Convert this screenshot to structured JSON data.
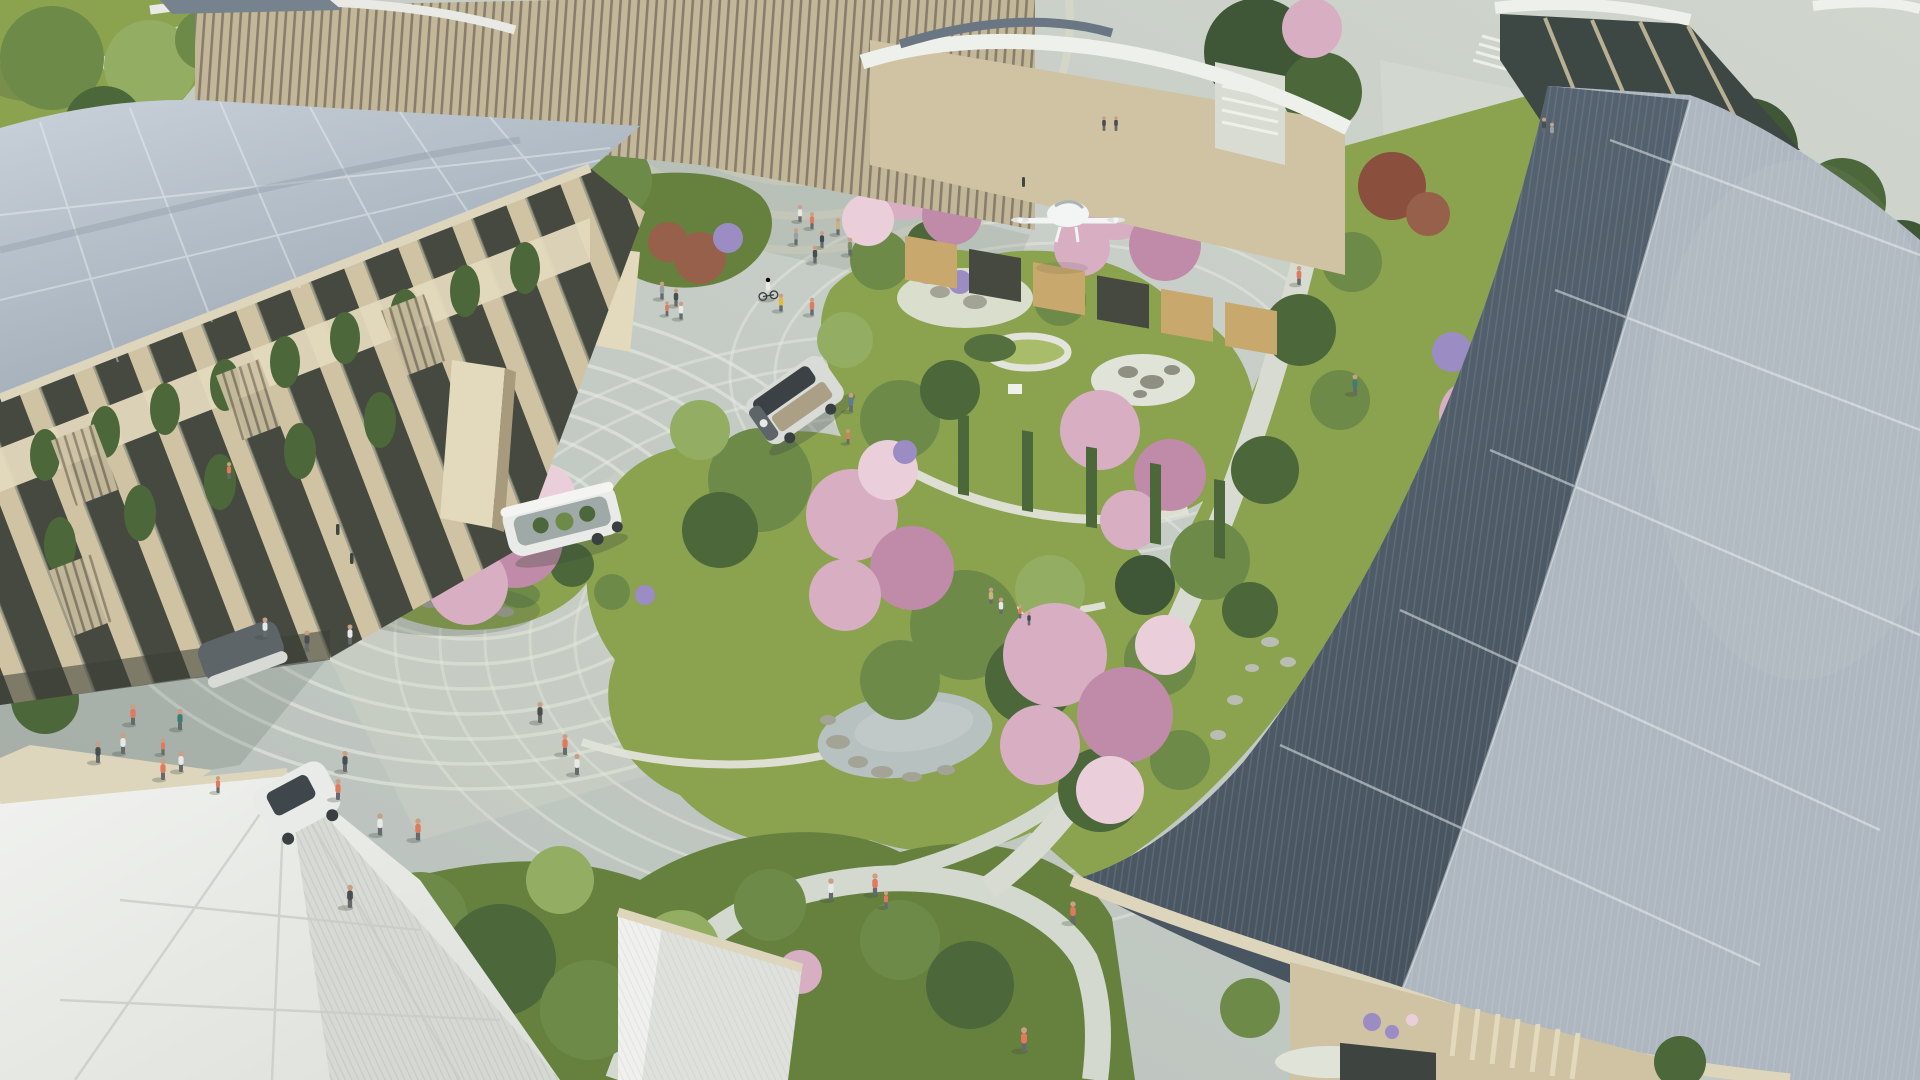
{
  "meta": {
    "title": "Aerial rendering — car-free smart neighborhood plaza",
    "type": "architectural rendering",
    "view": "aerial oblique, daytime",
    "description": "Sunlit aerial view of a woven-city style neighborhood: mass-timber buildings with curved solar roofs, a central Japanese garden with cherry blossoms, a pond and zen gravel circles, wavy-striped pedestrian plazas, autonomous shuttles, a hovering delivery drone and many pedestrians."
  },
  "palette": {
    "pavement": "#c3cac4",
    "pavementLight": "#d6dbd2",
    "stripe": "#e9ece3",
    "terrace": "#dbd8c6",
    "grass": "#8ba24f",
    "grassLight": "#a9bc69",
    "grassDark": "#66813e",
    "foliage": "#6d8a49",
    "foliageLight": "#93ad62",
    "foliageDark": "#4c673a",
    "foliageDeep": "#3f5736",
    "blossom": "#d8aec3",
    "blossomLight": "#eacfdb",
    "blossomDeep": "#c08ba8",
    "flowerPurple": "#9b8cc4",
    "rust": "#96604a",
    "maroon": "#8a4f3d",
    "timber": "#cfc3a3",
    "timberLight": "#e3d9bd",
    "timberDark": "#a89b7d",
    "fascia": "#ddd5bc",
    "glass": "#45493f",
    "warmGlow": "#c9a86d",
    "roofLeft": "#b2bcc6",
    "roofLeftHi": "#c9d1d9",
    "roofLeftShade": "#8f9ba8",
    "roofDark": "#4f5d6b",
    "roofMid": "#6b7987",
    "roofLight": "#aeb7bf",
    "roofLightHi": "#c6ccd1",
    "seam": "#edf1f3",
    "canopy": "#eceded",
    "canopyShade": "#d3d6d1",
    "water": "#b7c1c0",
    "rock": "#a3a396",
    "gravel": "#e0e3d8",
    "vehicleWhite": "#e9ebe8",
    "vehicleGray": "#8e979b",
    "vehicleDark": "#5e6569",
    "wheel": "#3a3f42",
    "glassTint": "#9fa9a8",
    "droneWhite": "#f3f5f4",
    "skin": "#c99f85",
    "legs": "#666a6d",
    "shadow": "#3d4a3c",
    "shirtCoral": "#e07a5f",
    "shirtWhite": "#e8e9e6",
    "shirtGray": "#9aa0a2",
    "shirtNavy": "#3e4a5a",
    "shirtTan": "#c9b27e",
    "shirtSage": "#7e8f6e",
    "shirtCharcoal": "#494e51",
    "shirtYellow": "#e5b93e",
    "shirtTeal": "#3f7d74",
    "shirtDenim": "#5b7b9a"
  },
  "scene": {
    "environment": {
      "setting": "pedestrian plaza and gardens between buildings",
      "weather": "sunny",
      "shadows": "long, cast toward lower left"
    },
    "buildings": [
      {
        "name": "timber-louver-building",
        "position": "top left to top center",
        "features": "vertical wooden fins, thin curved white roof band"
      },
      {
        "name": "left-mass-timber-building",
        "position": "left",
        "features": "two storeys, dark glazing, hanging plant balconies, pale blue-grey solar shingle roof with diamond seams"
      },
      {
        "name": "courtyard-building",
        "position": "top center",
        "features": "warm lit windows, vertical green planting strips, curved white roof with dark solar strip"
      },
      {
        "name": "glass-pavilion",
        "position": "top right",
        "features": "full-height glazing with timber mullions, curved white fascia"
      },
      {
        "name": "solar-roof-hall",
        "position": "right",
        "features": "large curved photovoltaic roof, dark blue and pale panel fields, beige eave fascia, ground-floor window with flowers and louver fence"
      }
    ],
    "vehicles": [
      {
        "name": "autonomous-shuttle",
        "style": "e-Palette box van",
        "color": "white frame, dark roof panel, warm interior",
        "state": "driving across central plaza"
      },
      {
        "name": "glass-sided-shuttle",
        "color": "white frame, glass sides with plants visible inside",
        "state": "driving near left building"
      },
      {
        "name": "parked-shuttle",
        "color": "white with dark glazing",
        "state": "partly hidden behind white canopy, bottom left"
      }
    ],
    "aircraft": [
      {
        "name": "delivery-drone",
        "color": "white",
        "state": "hovering beside cherry trees near courtyard building"
      }
    ],
    "landscape": [
      {
        "name": "central-garden-islands",
        "count": 2,
        "features": "mounded shrubs, tall grasses, bonsai pines"
      },
      {
        "name": "cherry-blossom-trees",
        "count": 9,
        "color": "pink"
      },
      {
        "name": "zen-gravel-circles",
        "count": 2,
        "features": "white gravel with scattered dark rocks"
      },
      {
        "name": "round-planter-ring",
        "count": 1
      },
      {
        "name": "pond",
        "count": 1,
        "features": "rock edge"
      },
      {
        "name": "wavy-striped-paving",
        "features": "white flowing stripes over grey stone plaza"
      },
      {
        "name": "white-event-canopies",
        "count": 3,
        "position": "bottom left and bottom center"
      }
    ],
    "people": {
      "count": 51,
      "notes": "strollers, a cyclist, children, elderly couple seated on curved garden wall, person on balcony, figures in windows"
    }
  }
}
